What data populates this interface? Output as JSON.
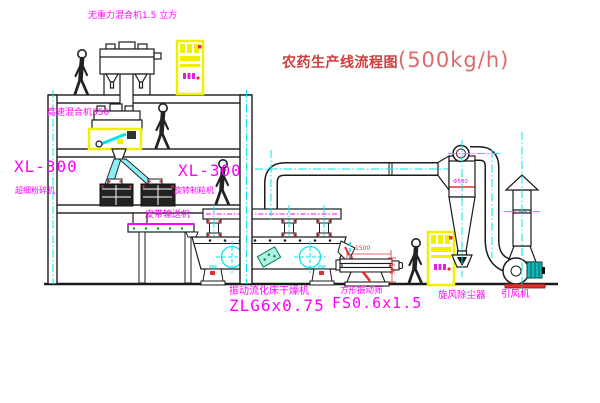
{
  "title": {
    "name": "农药生产线流程图",
    "capacity": "(500kg/h)"
  },
  "labels": {
    "gravity_mixer": "无重力混合机1.5 立方",
    "high_speed_mixer": "高速混合机350",
    "pulverizer_model": "XL-300",
    "pulverizer_name": "超细粉碎机",
    "granulator_model": "XL-300",
    "granulator_name": "旋转制粒机",
    "belt_conveyor": "皮带输送机",
    "dryer_name": "振动流化床干燥机",
    "dryer_model": "ZLG6x0.75",
    "sifter_name": "方形振动筛",
    "sifter_model": "FS0.6x1.5",
    "cyclone_name": "旋风除尘器",
    "fan_name": "引风机"
  },
  "annotations": {
    "sifter_length_dim": "1500",
    "sifter_height_dim": "545",
    "cyclone_diameter": "Φ580"
  },
  "colors": {
    "line": "#1b1b1b",
    "centerline": "#00e4f0",
    "label": "#ff00ff",
    "title-main": "#cc3f3f",
    "title-capacity": "#dd6b6b",
    "dim-red": "#e03030",
    "highlight-yellow": "#f0f000",
    "duct-cyan": "#8deef5",
    "motor-teal": "#18b5b5"
  }
}
